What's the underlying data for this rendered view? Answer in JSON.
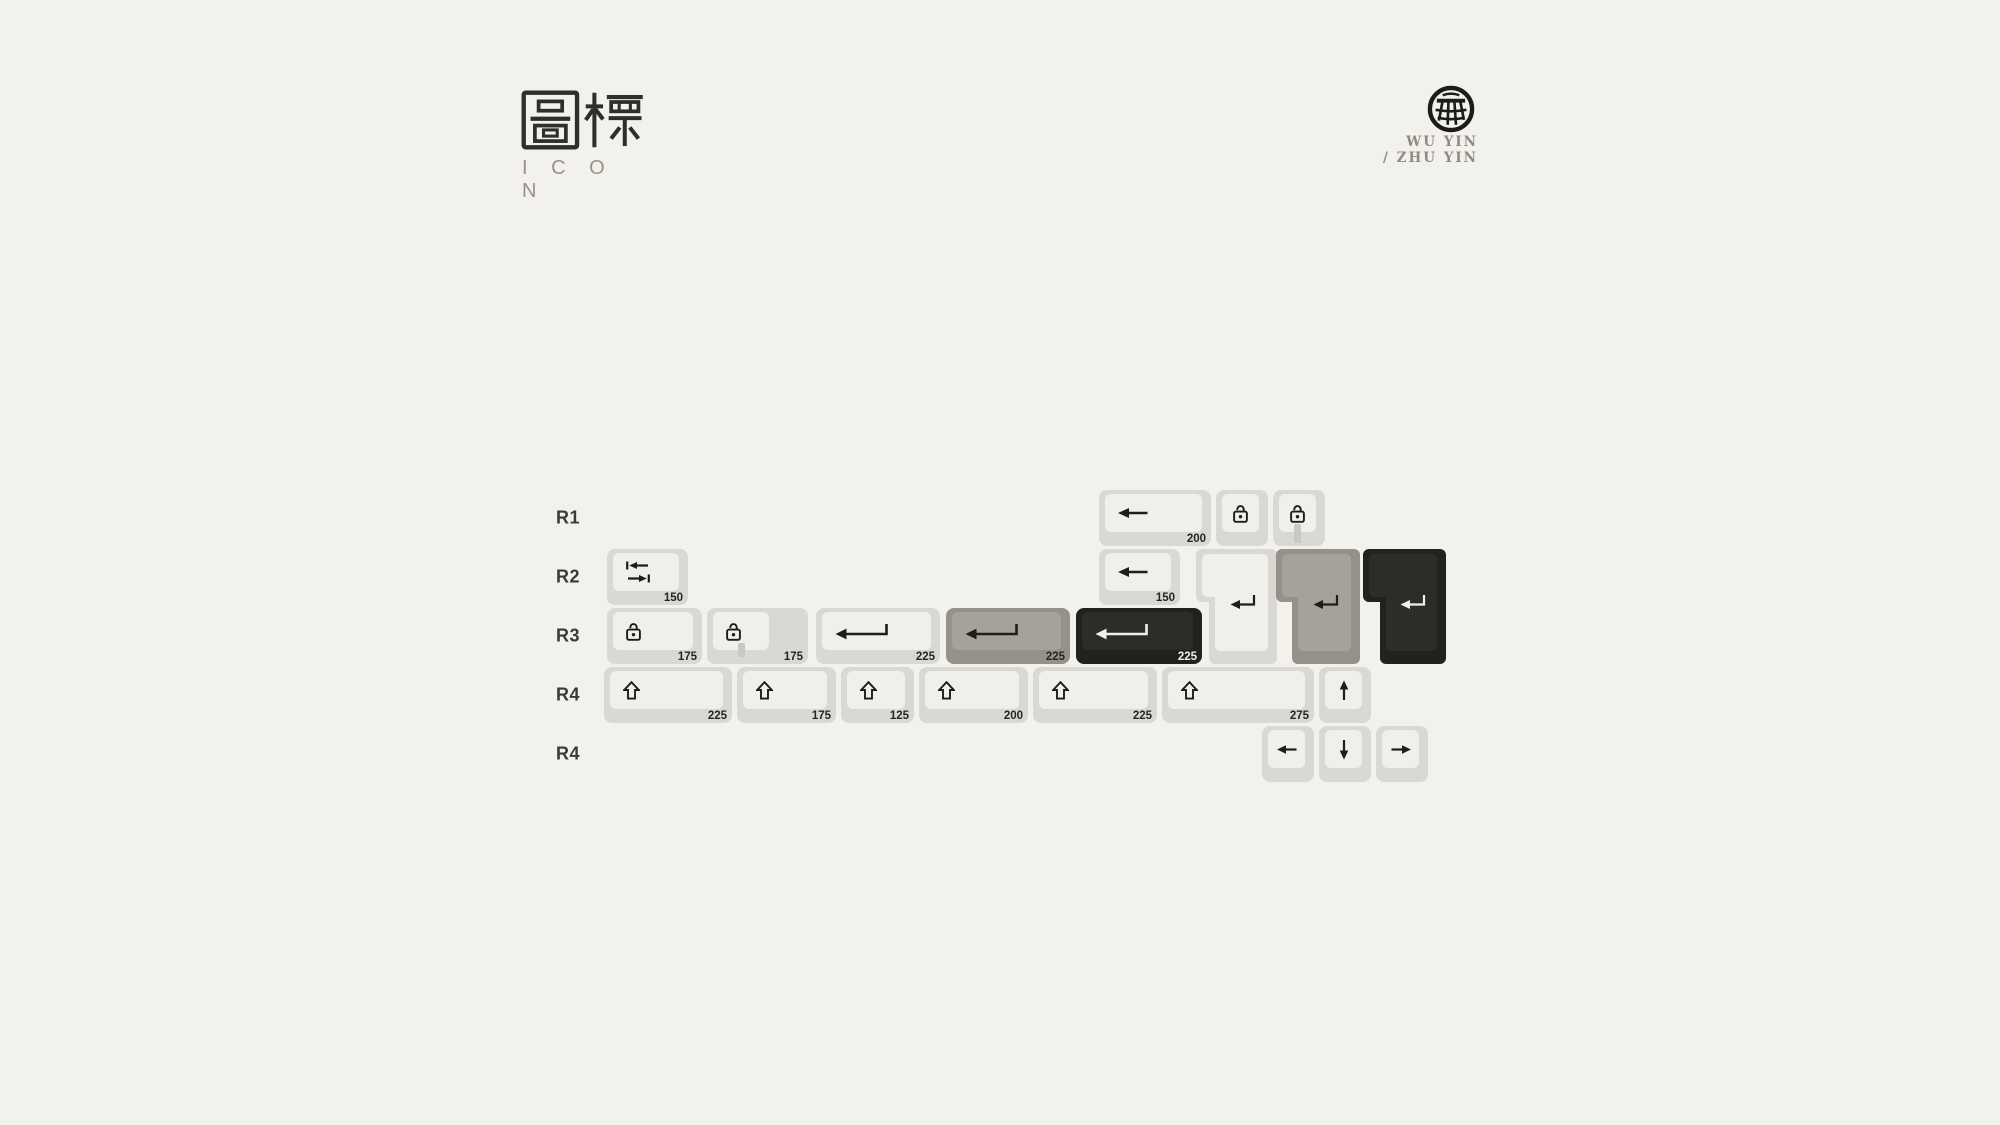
{
  "header": {
    "title_cjk": "圖標",
    "title_latin": "I C O N"
  },
  "brand": {
    "line1": "WU YIN",
    "line2": "/ ZHU YIN",
    "logo": "wu-yin-grid-logo"
  },
  "colors": {
    "background": "#f2f1ec",
    "key_white_base": "#d9d8d3",
    "key_white_top": "#f0efe9",
    "key_gray_base": "#95908a",
    "key_gray_top": "#a6a29b",
    "key_black_base": "#222120",
    "key_black_top": "#2d2c29",
    "ink": "#1e1d1a",
    "ink_on_black": "#f0efeb",
    "led_window": "#c9c8c2",
    "label": "#26251f",
    "row_label": "#3b3a36"
  },
  "keyboard": {
    "label_x": 556,
    "rows": [
      {
        "label": "R1",
        "y": 490
      },
      {
        "label": "R2",
        "y": 549
      },
      {
        "label": "R3",
        "y": 608
      },
      {
        "label": "R4",
        "y": 667
      },
      {
        "label": "R4",
        "y": 726
      }
    ],
    "keys": [
      {
        "name": "keycap-backspace-200",
        "row": 0,
        "x": 1099,
        "w": 112,
        "color": "white",
        "icon": "arrow-left",
        "label": "200"
      },
      {
        "name": "keycap-lock-100",
        "row": 0,
        "x": 1216,
        "w": 52,
        "color": "white",
        "icon": "lock"
      },
      {
        "name": "keycap-lock-led-100",
        "row": 0,
        "x": 1273,
        "w": 52,
        "color": "white",
        "icon": "lock",
        "led": true
      },
      {
        "name": "keycap-tab-150",
        "row": 1,
        "x": 607,
        "w": 81,
        "color": "white",
        "icon": "tab",
        "label": "150"
      },
      {
        "name": "keycap-backspace-150",
        "row": 1,
        "x": 1099,
        "w": 81,
        "color": "white",
        "icon": "arrow-left",
        "label": "150"
      },
      {
        "name": "keycap-iso-enter-white",
        "row": 1,
        "x": 1196,
        "w": 81,
        "color": "white",
        "icon": "return",
        "shape": "iso",
        "bi": 13
      },
      {
        "name": "keycap-iso-enter-gray",
        "row": 1,
        "x": 1276,
        "w": 84,
        "color": "gray",
        "icon": "return",
        "shape": "iso",
        "bi": 16
      },
      {
        "name": "keycap-iso-enter-black",
        "row": 1,
        "x": 1363,
        "w": 83,
        "color": "black",
        "icon": "return",
        "shape": "iso",
        "bi": 17
      },
      {
        "name": "keycap-lock-175",
        "row": 2,
        "x": 607,
        "w": 95,
        "color": "white",
        "icon": "lock",
        "label": "175"
      },
      {
        "name": "keycap-stepped-capslock-175",
        "row": 2,
        "x": 707,
        "w": 101,
        "color": "white",
        "icon": "lock",
        "label": "175",
        "led": true,
        "stepped": true
      },
      {
        "name": "keycap-enter-225-white",
        "row": 2,
        "x": 816,
        "w": 124,
        "color": "white",
        "icon": "return-long",
        "label": "225"
      },
      {
        "name": "keycap-enter-225-gray",
        "row": 2,
        "x": 946,
        "w": 124,
        "color": "gray",
        "icon": "return-long",
        "label": "225"
      },
      {
        "name": "keycap-enter-225-black",
        "row": 2,
        "x": 1076,
        "w": 126,
        "color": "black",
        "icon": "return-long",
        "label": "225"
      },
      {
        "name": "keycap-shift-225",
        "row": 3,
        "x": 604,
        "w": 128,
        "color": "white",
        "icon": "shift",
        "label": "225"
      },
      {
        "name": "keycap-shift-175",
        "row": 3,
        "x": 737,
        "w": 99,
        "color": "white",
        "icon": "shift",
        "label": "175"
      },
      {
        "name": "keycap-shift-125",
        "row": 3,
        "x": 841,
        "w": 73,
        "color": "white",
        "icon": "shift",
        "label": "125"
      },
      {
        "name": "keycap-shift-200",
        "row": 3,
        "x": 919,
        "w": 109,
        "color": "white",
        "icon": "shift",
        "label": "200"
      },
      {
        "name": "keycap-shift-225-b",
        "row": 3,
        "x": 1033,
        "w": 124,
        "color": "white",
        "icon": "shift",
        "label": "225"
      },
      {
        "name": "keycap-shift-275",
        "row": 3,
        "x": 1162,
        "w": 152,
        "color": "white",
        "icon": "shift",
        "label": "275"
      },
      {
        "name": "keycap-arrow-up",
        "row": 3,
        "x": 1319,
        "w": 52,
        "color": "white",
        "icon": "arrow-up"
      },
      {
        "name": "keycap-arrow-left",
        "row": 4,
        "x": 1262,
        "w": 52,
        "color": "white",
        "icon": "arrow-left-sm"
      },
      {
        "name": "keycap-arrow-down",
        "row": 4,
        "x": 1319,
        "w": 52,
        "color": "white",
        "icon": "arrow-down"
      },
      {
        "name": "keycap-arrow-right",
        "row": 4,
        "x": 1376,
        "w": 52,
        "color": "white",
        "icon": "arrow-right"
      }
    ]
  }
}
